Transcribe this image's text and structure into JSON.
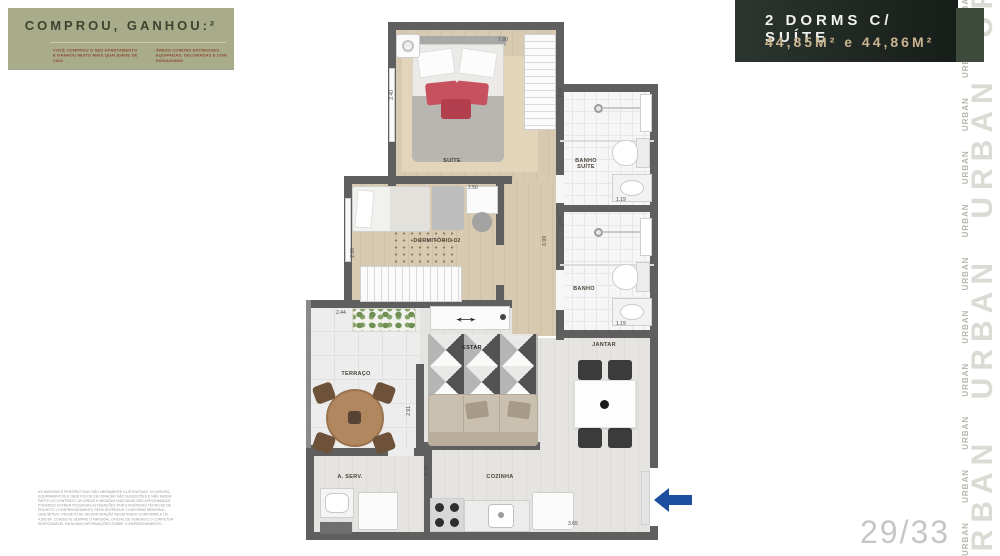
{
  "promo": {
    "title": "COMPROU, GANHOU:²",
    "note_left": "VOCÊ COMPROU O SEU APARTAMENTO E GANHOU MUITO MAIS QUALIDADE DE VIDA",
    "note_right": "ÁREAS COMUNS ENTREGUES EQUIPADAS, DECORADAS E COM PAISAGISMO"
  },
  "unit_header": {
    "title": "2 DORMS C/ SUÍTE",
    "area": "44,85M² e 44,86M²"
  },
  "brand": {
    "word": "URBAN",
    "large_column": "URBAN URBAN URBAN URBAN URBAN",
    "small_column": "URBAN URBAN URBAN URBAN URBAN URBAN URBAN URBAN URBAN URBAN URBAN URBAN"
  },
  "page_indicator": "29/33",
  "floorplan": {
    "rooms": {
      "suite": "SUÍTE",
      "dorm2": "DORMITÓRIO 02",
      "banho_suite": "BANHO SUÍTE",
      "banho": "BANHO",
      "terraco": "TERRAÇO",
      "estar": "ESTAR",
      "jantar": "JANTAR",
      "cozinha": "COZINHA",
      "aserv": "A. SERV."
    },
    "dims": {
      "suite_w": "7.90",
      "suite_h": "2.40",
      "dorm2_w": "2.50",
      "dorm2_h": "2.00",
      "banho_suite_h": "2.44",
      "banho_suite_w": "1.19",
      "banho_h": "2.14",
      "banho_w": "1.19",
      "hall_l": "6.99",
      "terraco_w": "2.44",
      "estar_h": "2.91",
      "cozinha_h": "1.43",
      "cozinha_w": "3.65"
    }
  },
  "legal": {
    "text": "AS IMAGENS E PERSPECTIVAS SÃO MERAMENTE ILUSTRATIVAS. OS MÓVEIS, EQUIPAMENTOS E OBJETOS DE DECORAÇÃO SÃO SUGESTÕES E NÃO FAZEM PARTE DO CONTRATO. AS ÁREAS E MEDIDAS INDICADAS SÃO APROXIMADAS, PODENDO SOFRER PEQUENAS ALTERAÇÕES POR EXIGÊNCIAS TÉCNICAS DE PROJETO. O EMPREENDIMENTO SERÁ ENTREGUE CONFORME MEMORIAL DESCRITIVO. PROJETO DE INCORPORAÇÃO REGISTRADO CONFORME A LEI 4.591/64. CONSULTE SEMPRE O MATERIAL OFICIAL DE VENDAS E O CORRETOR RESPONSÁVEL PARA MAIS INFORMAÇÕES SOBRE O EMPREENDIMENTO."
  }
}
